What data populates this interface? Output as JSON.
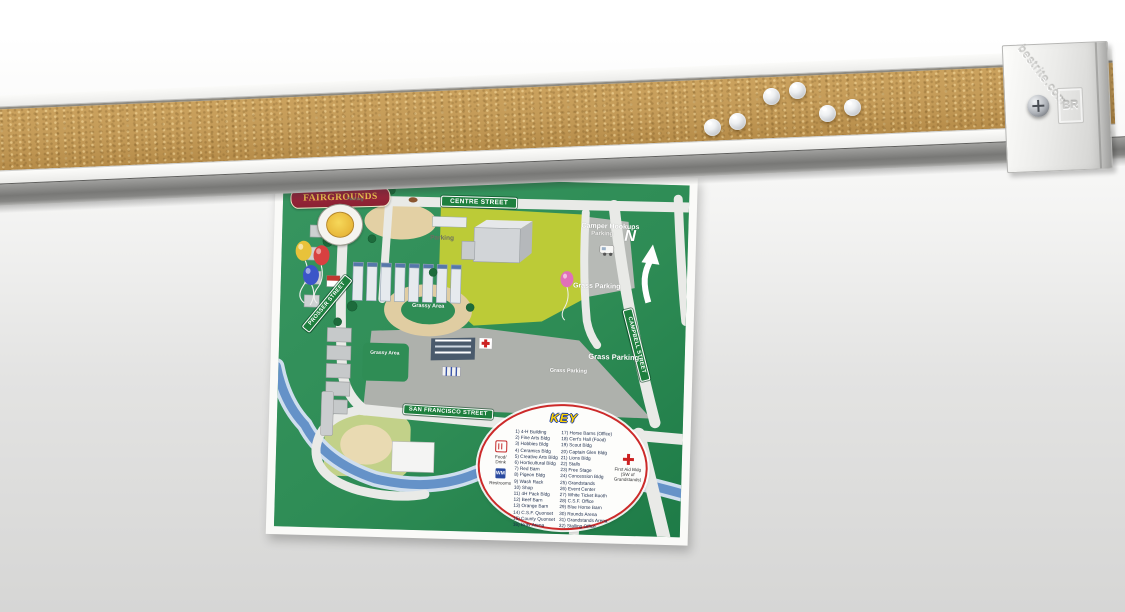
{
  "product": {
    "endcap": {
      "watermark": "bestrite.com",
      "logo_monogram": "BR"
    },
    "pushpins": {
      "count": 6,
      "style": "clear plastic"
    }
  },
  "map": {
    "title": "FAIRGROUNDS",
    "signs": {
      "centre": "CENTRE STREET",
      "san_francisco": "SAN FRANCISCO STREET",
      "campbell": "CAMPBELL STREET",
      "prosser": "PROSSER STREET"
    },
    "labels": {
      "camper_hookups": "Camper Hookups",
      "grass_parking_a": "Grass Parking",
      "grass_parking_b": "Grass Parking",
      "grass_parking_c": "Grass Parking",
      "parking_field": "Parking",
      "parking_lot": "Parking",
      "parking_small": "Parking",
      "grassy_area_1": "Grassy Area",
      "grassy_area_2": "Grassy Area",
      "north": "N"
    },
    "key": {
      "title": "KEY",
      "services": [
        {
          "label": "Food/ Drink"
        },
        {
          "label": "Restrooms"
        }
      ],
      "first_aid_label": "First Aid Bldg (SW of Grandstands)",
      "items_left": [
        "1) 4-H Building",
        "2) Fine Arts Bldg",
        "3) Hobbies Bldg",
        "4) Ceramics Bldg",
        "5) Creative Arts Bldg",
        "6) Horticultural Bldg",
        "7) Red Barn",
        "8) Pigeon Bldg",
        "9) Wash Rack",
        "10) Shop",
        "11) 4H Pack Bldg",
        "12) Beef Barn",
        "13) Orange Barn",
        "14) C.S.F. Quonset",
        "15) County Quonset",
        "16) Bray Arena"
      ],
      "items_right": [
        "17) Horse Barns (Office)",
        "18) Cert's Hall (Food)",
        "19) Scout Bldg",
        "20) Captain Glen Bldg",
        "21) Lions Bldg",
        "22) Stalls",
        "23) Free Stage",
        "24) Concession Bldg",
        "25) Grandstands",
        "26) Event Center",
        "27) White Ticket Booth",
        "28) C.S.F. Office",
        "29) Blue Horse Barn",
        "30) Rounds Arena",
        "31) Grandstands Arena",
        "32) Stalling Office"
      ]
    }
  },
  "colors": {
    "cork": "#c39a57",
    "rail_frame": "#f4f4f2",
    "rail_channel": "#8a8a88",
    "map_green": "#2e8c55",
    "field_yellow_green": "#bccb37",
    "road": "#e9eae7",
    "river": "#6592c8",
    "sign_green": "#1e7f3e",
    "key_border_red": "#cc2a2a",
    "key_title_yellow": "#ffd200",
    "banner_maroon": "#8c2132",
    "banner_gold": "#eec24e"
  }
}
